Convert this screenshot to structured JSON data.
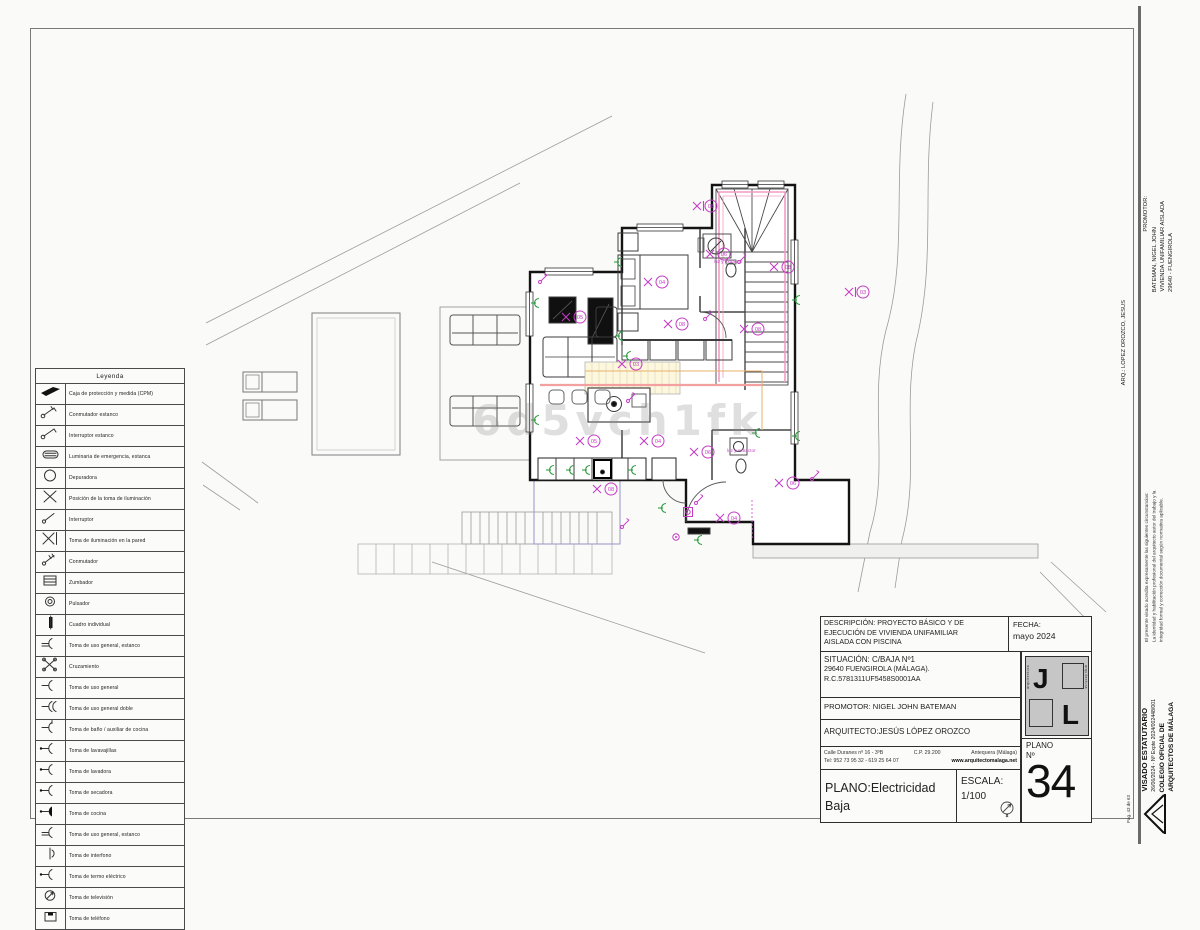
{
  "watermark": "6d5vch1fk",
  "legend": {
    "title": "Leyenda",
    "items": [
      {
        "sym": "cpm",
        "label": "Caja de protección y medida (CPM)"
      },
      {
        "sym": "conm_est",
        "label": "Conmutador  estanco"
      },
      {
        "sym": "int_est",
        "label": "Interruptor  estanco"
      },
      {
        "sym": "emerg",
        "label": "Luminaria  de  emergencia,  estanca"
      },
      {
        "sym": "depur",
        "label": "Depuradora"
      },
      {
        "sym": "pos",
        "label": "Posición  de  la  toma  de  iluminación"
      },
      {
        "sym": "int",
        "label": "Interruptor"
      },
      {
        "sym": "pared",
        "label": "Toma  de  iluminación  en  la  pared"
      },
      {
        "sym": "conm",
        "label": "Conmutador"
      },
      {
        "sym": "zumb",
        "label": "Zumbador"
      },
      {
        "sym": "puls",
        "label": "Pulsador"
      },
      {
        "sym": "cuadro",
        "label": "Cuadro  individual"
      },
      {
        "sym": "tge",
        "label": "Toma  de  uso  general,  estanco"
      },
      {
        "sym": "cruz",
        "label": "Cruzamiento"
      },
      {
        "sym": "tg",
        "label": "Toma  de  uso  general"
      },
      {
        "sym": "tgd",
        "label": "Toma  de  uso  general  doble"
      },
      {
        "sym": "tb",
        "label": "Toma  de  baño  /  auxiliar  de  cocina"
      },
      {
        "sym": "tlv",
        "label": "Toma  de  lavavajillas"
      },
      {
        "sym": "tl",
        "label": "Toma  de  lavadora"
      },
      {
        "sym": "ts",
        "label": "Toma  de  secadora"
      },
      {
        "sym": "tc",
        "label": "Toma  de  cocina"
      },
      {
        "sym": "tge2",
        "label": "Toma  de  uso  general,  estanco"
      },
      {
        "sym": "ti",
        "label": "Toma  de  interfono"
      },
      {
        "sym": "tt",
        "label": "Toma  de  termo  eléctrico"
      },
      {
        "sym": "ttv",
        "label": "Toma  de  televisión"
      },
      {
        "sym": "ttel",
        "label": "Toma  de  teléfono"
      }
    ]
  },
  "title_block": {
    "desc_line1": "DESCRIPCIÓN: PROYECTO BÁSICO Y DE",
    "desc_line2": "EJECUCIÓN DE VIVIENDA UNIFAMILIAR",
    "desc_line3": "AISLADA CON PISCINA",
    "fecha_label": "FECHA:",
    "fecha_value": "mayo  2024",
    "sit_line1": "SITUACIÓN:  C/BAJA Nº1",
    "sit_line2": "29640 FUENGIROLA (MÁLAGA).",
    "sit_line3": "R.C.5781311UF5458S0001AA",
    "promotor": "PROMOTOR: NIGEL JOHN BATEMAN",
    "arquitecto": "ARQUITECTO:JESÚS LÓPEZ OROZCO",
    "addr_street": "Calle Duranes nº 16 - 3ºB",
    "addr_cp": "C.P. 29.200",
    "addr_city": "Antequera (Málaga)",
    "addr_tel": "Tel: 952 73 95 32 - 619 25 64 07",
    "addr_web": "www.arquitectomalaga.net",
    "plano_line1": "PLANO:Electricidad",
    "plano_line2": "Baja",
    "escala_label": "ESCALA:",
    "escala_value": "1/100",
    "plano_no_label": "PLANO",
    "plano_no_sub": "Nº",
    "plano_no": "34",
    "logo_j": "J",
    "logo_l": "L",
    "logo_side_left": "arquitectura",
    "logo_side_right": "arquitectura"
  },
  "side_strip": {
    "promotor_label": "PROMOTOR:",
    "promotor_lines": [
      "BATEMAN, NIGEL JOHN",
      "VIVIENDA UNIFAMILIAR AISLADA",
      "29640 - FUENGIROLA"
    ],
    "arq": "ARQ.: LOPEZ OROZCO, JESUS",
    "visado_note": "El presente visado acredita expresamente las siguientes circunstancias: La identidad y habilitación profesional del arquitecto autor del trabajo y la integridad formal y corrección documental según normativa aplicable.",
    "visado_line1": "VISADO ESTATUTARIO",
    "visado_line2": "26/06/2024 - Nº Expte 2024/002448/001",
    "visado_line3": "COLEGIO OFICIAL DE",
    "visado_line4": "ARQUITECTOS DE MÁLAGA",
    "page_no": "Pag. 43 de 63"
  },
  "plan": {
    "colors": {
      "electric": "#c63cc6",
      "socket": "#2f9e44",
      "stair": "#f29cc4",
      "wiring": "#f2a0a0",
      "wiring2": "#e9b168"
    },
    "symbols": [
      {
        "t": "wl",
        "x": 697,
        "y": 206,
        "n": "08"
      },
      {
        "t": "l",
        "x": 710,
        "y": 254,
        "n": "06"
      },
      {
        "t": "l",
        "x": 774,
        "y": 267,
        "n": "08"
      },
      {
        "t": "wl",
        "x": 849,
        "y": 292,
        "n": "03"
      },
      {
        "t": "l",
        "x": 648,
        "y": 282,
        "n": "04"
      },
      {
        "t": "l",
        "x": 566,
        "y": 317,
        "n": "05"
      },
      {
        "t": "l",
        "x": 668,
        "y": 324,
        "n": "08"
      },
      {
        "t": "l",
        "x": 744,
        "y": 329,
        "n": "08"
      },
      {
        "t": "l",
        "x": 622,
        "y": 364,
        "n": "03"
      },
      {
        "t": "l",
        "x": 580,
        "y": 441,
        "n": "05"
      },
      {
        "t": "l",
        "x": 644,
        "y": 441,
        "n": "04"
      },
      {
        "t": "l",
        "x": 694,
        "y": 452,
        "n": "06"
      },
      {
        "t": "l",
        "x": 597,
        "y": 489,
        "n": "08"
      },
      {
        "t": "l",
        "x": 779,
        "y": 483,
        "n": "06"
      },
      {
        "t": "l",
        "x": 720,
        "y": 518,
        "n": "04"
      },
      {
        "t": "txt",
        "x": 714,
        "y": 263,
        "s": "luz y extractor"
      },
      {
        "t": "txt",
        "x": 727,
        "y": 452,
        "s": "luz y extractor"
      },
      {
        "t": "s",
        "x": 537,
        "y": 303
      },
      {
        "t": "s",
        "x": 537,
        "y": 420
      },
      {
        "t": "s",
        "x": 552,
        "y": 470
      },
      {
        "t": "s",
        "x": 572,
        "y": 470
      },
      {
        "t": "s",
        "x": 588,
        "y": 470
      },
      {
        "t": "s",
        "x": 634,
        "y": 470
      },
      {
        "t": "s",
        "x": 620,
        "y": 262
      },
      {
        "t": "s",
        "x": 621,
        "y": 336
      },
      {
        "t": "s",
        "x": 629,
        "y": 356
      },
      {
        "t": "s",
        "x": 798,
        "y": 300
      },
      {
        "t": "s",
        "x": 798,
        "y": 436
      },
      {
        "t": "s",
        "x": 758,
        "y": 433
      },
      {
        "t": "s",
        "x": 700,
        "y": 540
      },
      {
        "t": "s",
        "x": 664,
        "y": 508
      },
      {
        "t": "sw",
        "x": 540,
        "y": 279
      },
      {
        "t": "sw",
        "x": 628,
        "y": 398
      },
      {
        "t": "sw",
        "x": 696,
        "y": 500
      },
      {
        "t": "sw",
        "x": 739,
        "y": 259
      },
      {
        "t": "sw",
        "x": 705,
        "y": 316
      },
      {
        "t": "sw",
        "x": 622,
        "y": 524
      },
      {
        "t": "sw",
        "x": 812,
        "y": 476
      },
      {
        "t": "p",
        "x": 688,
        "y": 512
      },
      {
        "t": "b",
        "x": 676,
        "y": 537
      }
    ]
  }
}
